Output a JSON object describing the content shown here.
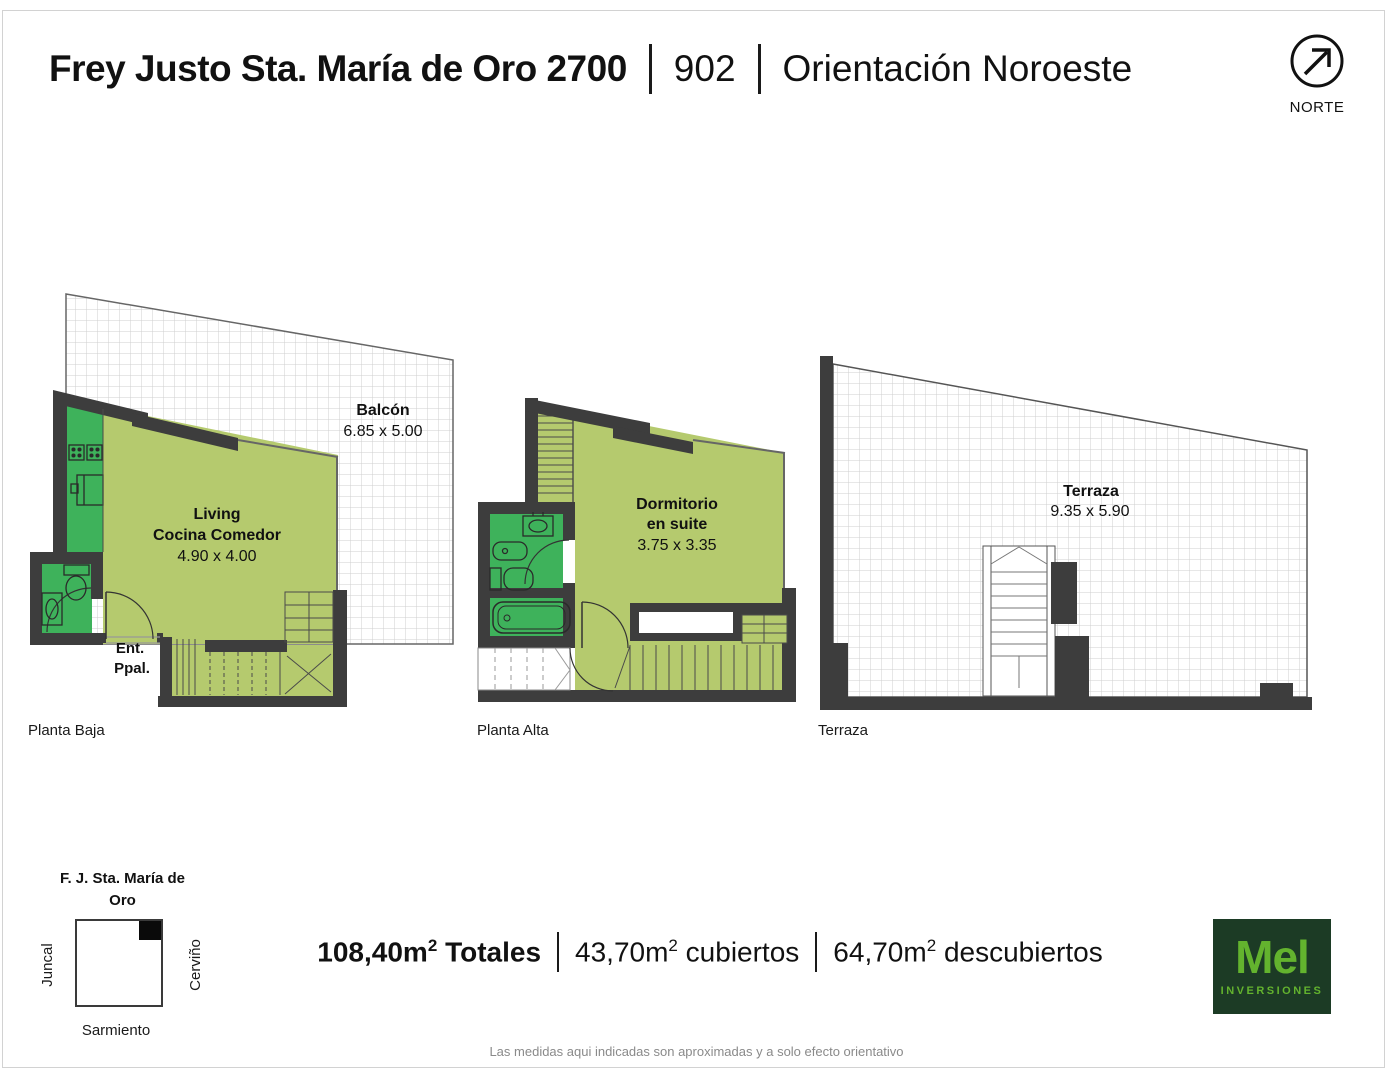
{
  "header": {
    "title": "Frey Justo Sta. María de Oro 2700",
    "unit": "902",
    "orientation": "Orientación Noroeste",
    "north": "NORTE"
  },
  "plans": {
    "baja": {
      "caption": "Planta Baja",
      "balcony_name": "Balcón",
      "balcony_dims": "6.85 x 5.00",
      "room_line1": "Living",
      "room_line2": "Cocina Comedor",
      "room_dims": "4.90 x 4.00",
      "entrance_line1": "Ent.",
      "entrance_line2": "Ppal."
    },
    "alta": {
      "caption": "Planta Alta",
      "room_line1": "Dormitorio",
      "room_line2": "en suite",
      "room_dims": "3.75 x 3.35"
    },
    "terraza": {
      "caption": "Terraza",
      "room_name": "Terraza",
      "room_dims": "9.35 x 5.90"
    }
  },
  "map": {
    "title_line1": "F. J. Sta. María de",
    "title_line2": "Oro",
    "street_left": "Juncal",
    "street_right": "Cerviño",
    "street_bottom": "Sarmiento"
  },
  "totals": {
    "total": {
      "prefix": "108,40m",
      "sup": "2",
      "label": "Totales"
    },
    "covered": {
      "prefix": "43,70m",
      "sup": "2",
      "label": "cubiertos"
    },
    "uncovered": {
      "prefix": "64,70m",
      "sup": "2",
      "label": "descubiertos"
    }
  },
  "logo": {
    "brand": "Mel",
    "subtitle": "INVERSIONES"
  },
  "disclaimer": "Las medidas aqui indicadas son aproximadas y a solo efecto orientativo",
  "colors": {
    "light_green": "#b5ca6e",
    "wet_green": "#3eb25b",
    "wall": "#3d3d3d",
    "logo_bg": "#1c3b25",
    "logo_green": "#63b32e"
  }
}
